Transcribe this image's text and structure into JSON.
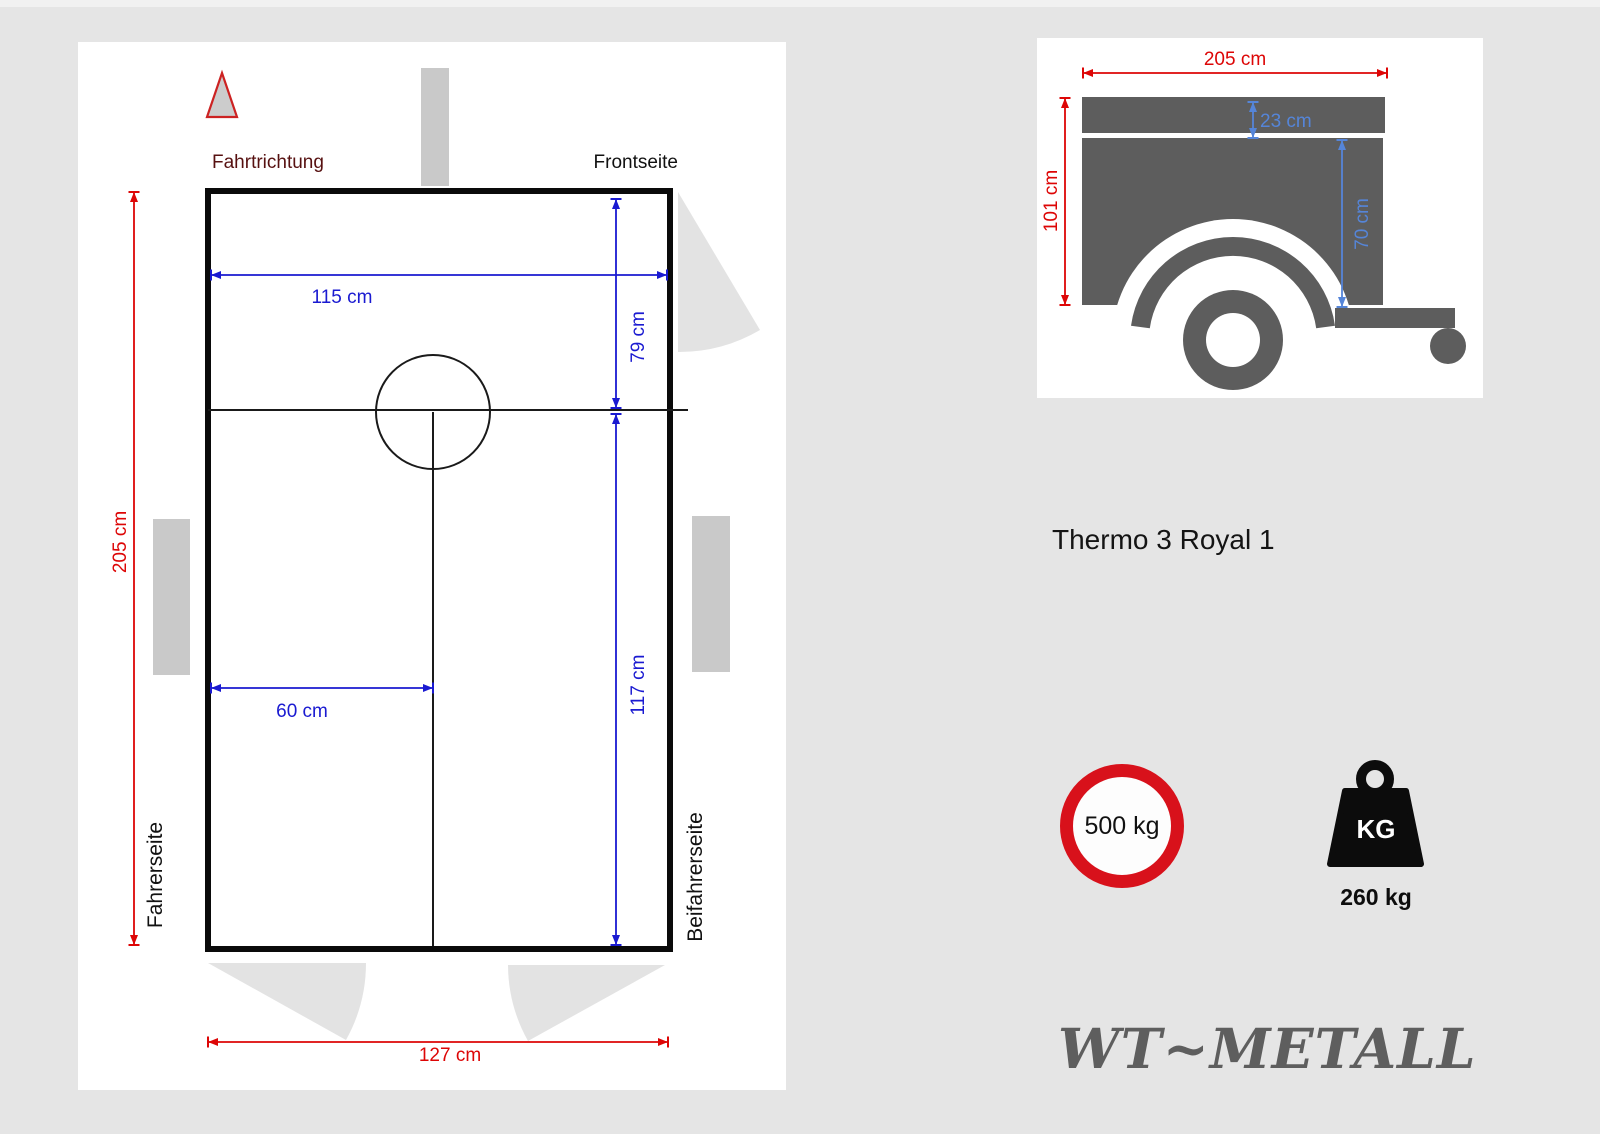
{
  "meta": {
    "background": "#e5e5e5",
    "accent_red": "#dd0606",
    "accent_blue": "#1a1ad1",
    "accent_blue_light": "#5585d8",
    "silhouette_gray": "#5d5d5d",
    "maroon": "#571111"
  },
  "top_view": {
    "direction_label": "Fahrtrichtung",
    "front_label": "Frontseite",
    "driver_side_label": "Fahrerseite",
    "passenger_side_label": "Beifahrerseite",
    "dims": {
      "total_length": "205 cm",
      "inner_width": "115 cm",
      "front_depth": "79 cm",
      "rear_depth": "117 cm",
      "axle_offset": "60 cm",
      "rear_width": "127 cm"
    }
  },
  "side_view": {
    "dims": {
      "total_length": "205 cm",
      "total_height": "101 cm",
      "lid_height": "23 cm",
      "body_height": "70 cm"
    }
  },
  "product": {
    "name": "Thermo 3 Royal 1"
  },
  "badges": {
    "max_load": "500 kg",
    "kg_label": "KG",
    "weight": "260 kg"
  },
  "brand": {
    "logo": "WT~METALL"
  }
}
